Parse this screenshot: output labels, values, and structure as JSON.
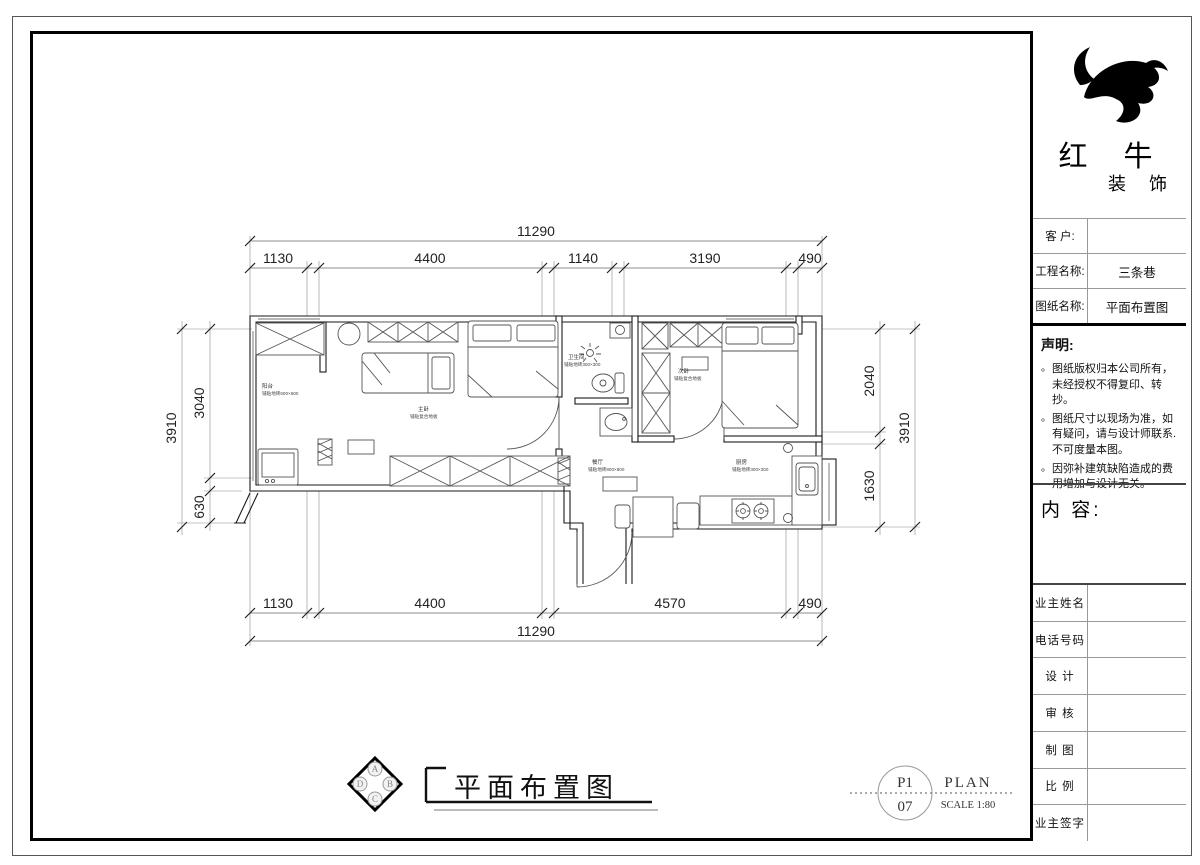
{
  "brand": {
    "name": "红 牛",
    "subname": "装 饰"
  },
  "title_block": {
    "bullet": "。",
    "fields": [
      {
        "label": "客  户:",
        "value": ""
      },
      {
        "label": "工程名称:",
        "value": "三条巷"
      },
      {
        "label": "图纸名称:",
        "value": "平面布置图"
      }
    ],
    "statement_title": "声明:",
    "statements": [
      "图纸版权归本公司所有，未经授权不得复印、转抄。",
      "图纸尺寸以现场为准，如有疑问，请与设计师联系. 不可度量本图。",
      "因弥补建筑缺陷造成的费用增加与设计无关。"
    ],
    "content_label": "内 容:",
    "sign_rows": [
      "业主姓名",
      "电话号码",
      "设 计",
      "审 核",
      "制 图",
      "比 例",
      "业主签字"
    ]
  },
  "plan": {
    "title": "平面布置图",
    "compass": [
      "A",
      "B",
      "C",
      "D"
    ],
    "stamp": {
      "page": "P1",
      "number": "07",
      "type": "PLAN",
      "scale": "SCALE 1:80"
    },
    "rooms": [
      {
        "name": "阳台",
        "finish": "铺贴地砖600×600"
      },
      {
        "name": "主卧",
        "finish": "铺贴复合地板"
      },
      {
        "name": "卫生间",
        "finish": "铺贴地砖300×300"
      },
      {
        "name": "次卧",
        "finish": "铺贴复合地板"
      },
      {
        "name": "餐厅",
        "finish": "铺贴地砖800×800"
      },
      {
        "name": "厨房",
        "finish": "铺贴地砖300×300"
      }
    ],
    "dimensions": {
      "top_total": "11290",
      "top_segments": [
        "1130",
        "4400",
        "1140",
        "3190",
        "490"
      ],
      "bottom_segments": [
        "1130",
        "4400",
        "4570",
        "490"
      ],
      "bottom_total": "11290",
      "left_total": "3910",
      "left_segments": [
        "3040",
        "630"
      ],
      "right_segments": [
        "2040",
        "1630"
      ],
      "right_total": "3910"
    }
  }
}
